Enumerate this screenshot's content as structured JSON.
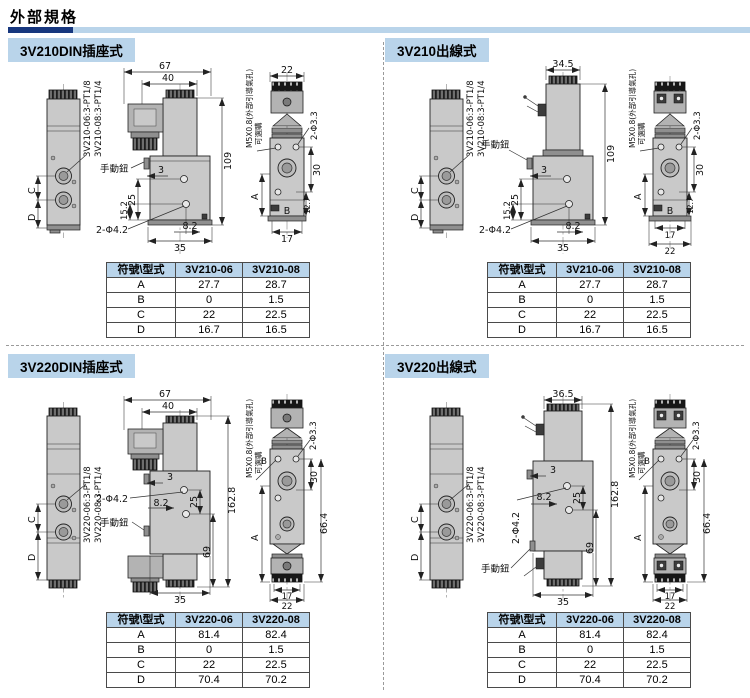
{
  "page": {
    "title": "外部規格"
  },
  "sections": [
    {
      "header": "3V210DIN插座式",
      "port_label_06": "3V210-06:3-PT1/8",
      "port_label_08": "3V210-08:3-PT1/4",
      "side": {
        "c": "C",
        "d": "D"
      },
      "front": {
        "w_total": "67",
        "w_coil": "40",
        "height": "109",
        "manual": "手動鈕",
        "d3": "3",
        "d25": "25",
        "d15_2": "15.2",
        "holes": "2-Φ4.2",
        "d8_2": "8.2",
        "d35": "35"
      },
      "end": {
        "w22": "22",
        "pilot": "M5X0.8(外部引導氣孔)",
        "optional": "可選購",
        "holes": "2-Φ3.3",
        "d30": "30",
        "d12_7": "12.7",
        "a": "A",
        "b": "B",
        "d17": "17"
      },
      "table": {
        "c0": "符號\\型式",
        "c1": "3V210-06",
        "c2": "3V210-08",
        "rows": [
          [
            "A",
            "27.7",
            "28.7"
          ],
          [
            "B",
            "0",
            "1.5"
          ],
          [
            "C",
            "22",
            "22.5"
          ],
          [
            "D",
            "16.7",
            "16.5"
          ]
        ]
      }
    },
    {
      "header": "3V210出線式",
      "port_label_06": "3V210-06:3-PT1/8",
      "port_label_08": "3V210-08:3-PT1/4",
      "side": {
        "c": "C",
        "d": "D"
      },
      "front": {
        "w_coil": "34.5",
        "height": "109",
        "manual": "手動鈕",
        "d3": "3",
        "d25": "25",
        "d15_2": "15.2",
        "holes": "2-Φ4.2",
        "d8_2": "8.2",
        "d35": "35"
      },
      "end": {
        "pilot": "M5X0.8(外部引導氣孔)",
        "optional": "可選購",
        "holes": "2-Φ3.3",
        "d30": "30",
        "d12_7": "12.7",
        "a": "A",
        "b": "B",
        "d17": "17",
        "d22": "22"
      },
      "table": {
        "c0": "符號\\型式",
        "c1": "3V210-06",
        "c2": "3V210-08",
        "rows": [
          [
            "A",
            "27.7",
            "28.7"
          ],
          [
            "B",
            "0",
            "1.5"
          ],
          [
            "C",
            "22",
            "22.5"
          ],
          [
            "D",
            "16.7",
            "16.5"
          ]
        ]
      }
    },
    {
      "header": "3V220DIN插座式",
      "port_label_06": "3V220-06:3-PT1/8",
      "port_label_08": "3V220-08:3-PT1/4",
      "side": {
        "c": "C",
        "d": "D"
      },
      "front": {
        "w_total": "67",
        "w_coil": "40",
        "height": "162.8",
        "manual": "手動鈕",
        "d3": "3",
        "d25": "25",
        "d69": "69",
        "holes": "2-Φ4.2",
        "d8_2": "8.2",
        "d35": "35"
      },
      "end": {
        "pilot": "M5X0.8(外部引導氣孔)",
        "optional": "可選購",
        "holes": "2-Φ3.3",
        "d30": "30",
        "d66_4": "66.4",
        "a": "A",
        "b": "B",
        "d17": "17",
        "d22": "22"
      },
      "table": {
        "c0": "符號\\型式",
        "c1": "3V220-06",
        "c2": "3V220-08",
        "rows": [
          [
            "A",
            "81.4",
            "82.4"
          ],
          [
            "B",
            "0",
            "1.5"
          ],
          [
            "C",
            "22",
            "22.5"
          ],
          [
            "D",
            "70.4",
            "70.2"
          ]
        ]
      }
    },
    {
      "header": "3V220出線式",
      "port_label_06": "3V220-06:3-PT1/8",
      "port_label_08": "3V220-08:3-PT1/4",
      "side": {
        "c": "C",
        "d": "D"
      },
      "front": {
        "w_coil": "36.5",
        "height": "162.8",
        "manual": "手動鈕",
        "d3": "3",
        "d25": "25",
        "d69": "69",
        "holes": "2-Φ4.2",
        "d8_2": "8.2",
        "d35": "35"
      },
      "end": {
        "pilot": "M5X0.8(外部引導氣孔)",
        "optional": "可選購",
        "holes": "2-Φ3.3",
        "d30": "30",
        "d66_4": "66.4",
        "a": "A",
        "b": "B",
        "d17": "17",
        "d22": "22"
      },
      "table": {
        "c0": "符號\\型式",
        "c1": "3V220-06",
        "c2": "3V220-08",
        "rows": [
          [
            "A",
            "81.4",
            "82.4"
          ],
          [
            "B",
            "0",
            "1.5"
          ],
          [
            "C",
            "22",
            "22.5"
          ],
          [
            "D",
            "70.4",
            "70.2"
          ]
        ]
      }
    }
  ]
}
